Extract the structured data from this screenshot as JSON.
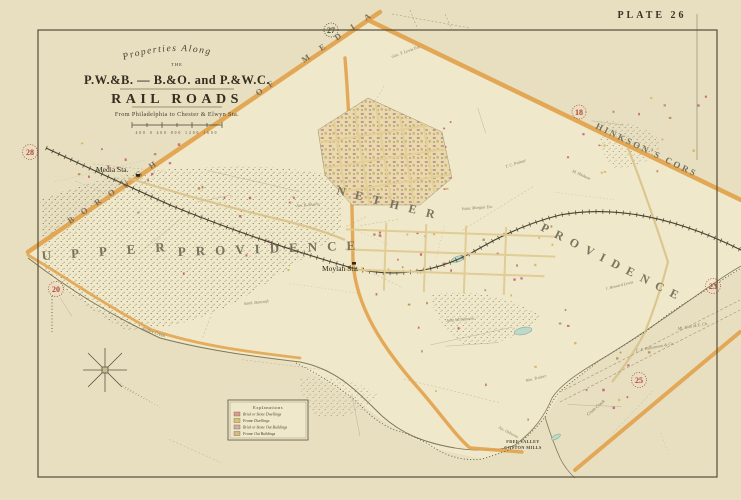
{
  "plate_label": "PLATE 26",
  "title_block": {
    "line1": "Properties Along",
    "line2": "THE",
    "line3": "P.W.&B. — B.&O. and P.&W.C.",
    "line4": "RAIL ROADS",
    "line5": "From Philadelphia to Chester & Elwyn Sta.",
    "scale_labels": "400   0   400   800   1200   1600"
  },
  "regions": {
    "borough": "BOROUGH",
    "of": "OF",
    "media": "MEDIA",
    "hinksons": "HINKSON'S CORS",
    "upper": "UPPER",
    "providence_left": "PROVIDENCE",
    "nether": "NETHER",
    "providence_right": "PROVIDENCE"
  },
  "stations": {
    "media": "Media Sta.",
    "moylan": "Moylan Sta."
  },
  "refs": [
    "27",
    "28",
    "18",
    "20",
    "23",
    "25"
  ],
  "legend": {
    "title": "Explanations",
    "items": [
      {
        "label": "Brick or Stone Dwellings",
        "color": "#dd9a97"
      },
      {
        "label": "Frame Dwellings",
        "color": "#dcc26e"
      },
      {
        "label": "Brick or Stone Out Buildings",
        "color": "#d3aca4"
      },
      {
        "label": "Frame Out Buildings",
        "color": "#d2bc82"
      }
    ]
  },
  "places": {
    "free_valley": "FREE VALLEY",
    "free_valley_sub": "COTTON MILLS"
  },
  "waterways": {
    "ridley": "Ridley Creek",
    "crum": "Crum Creek"
  },
  "owners": [
    {
      "text": "Jas. B. Morris"
    },
    {
      "text": "Geo. T. Lewis Est."
    },
    {
      "text": "M. Hinkson"
    },
    {
      "text": "Saml. Bancroft"
    },
    {
      "text": "Isaac Morgan Est."
    },
    {
      "text": "T. C. Palmer"
    },
    {
      "text": "John Williamson"
    },
    {
      "text": "J. Howard Lewis"
    },
    {
      "text": "Mt. Zion M.E. Ch."
    },
    {
      "text": "C. F. Williamson & Co."
    },
    {
      "text": "Wm. Trainer"
    },
    {
      "text": "Jos. Osborne"
    }
  ],
  "colors": {
    "road_orange": "#e2a24b",
    "water": "#bcd9c9",
    "reference_red": "#b2453a",
    "paper": "#e7dfc0"
  }
}
